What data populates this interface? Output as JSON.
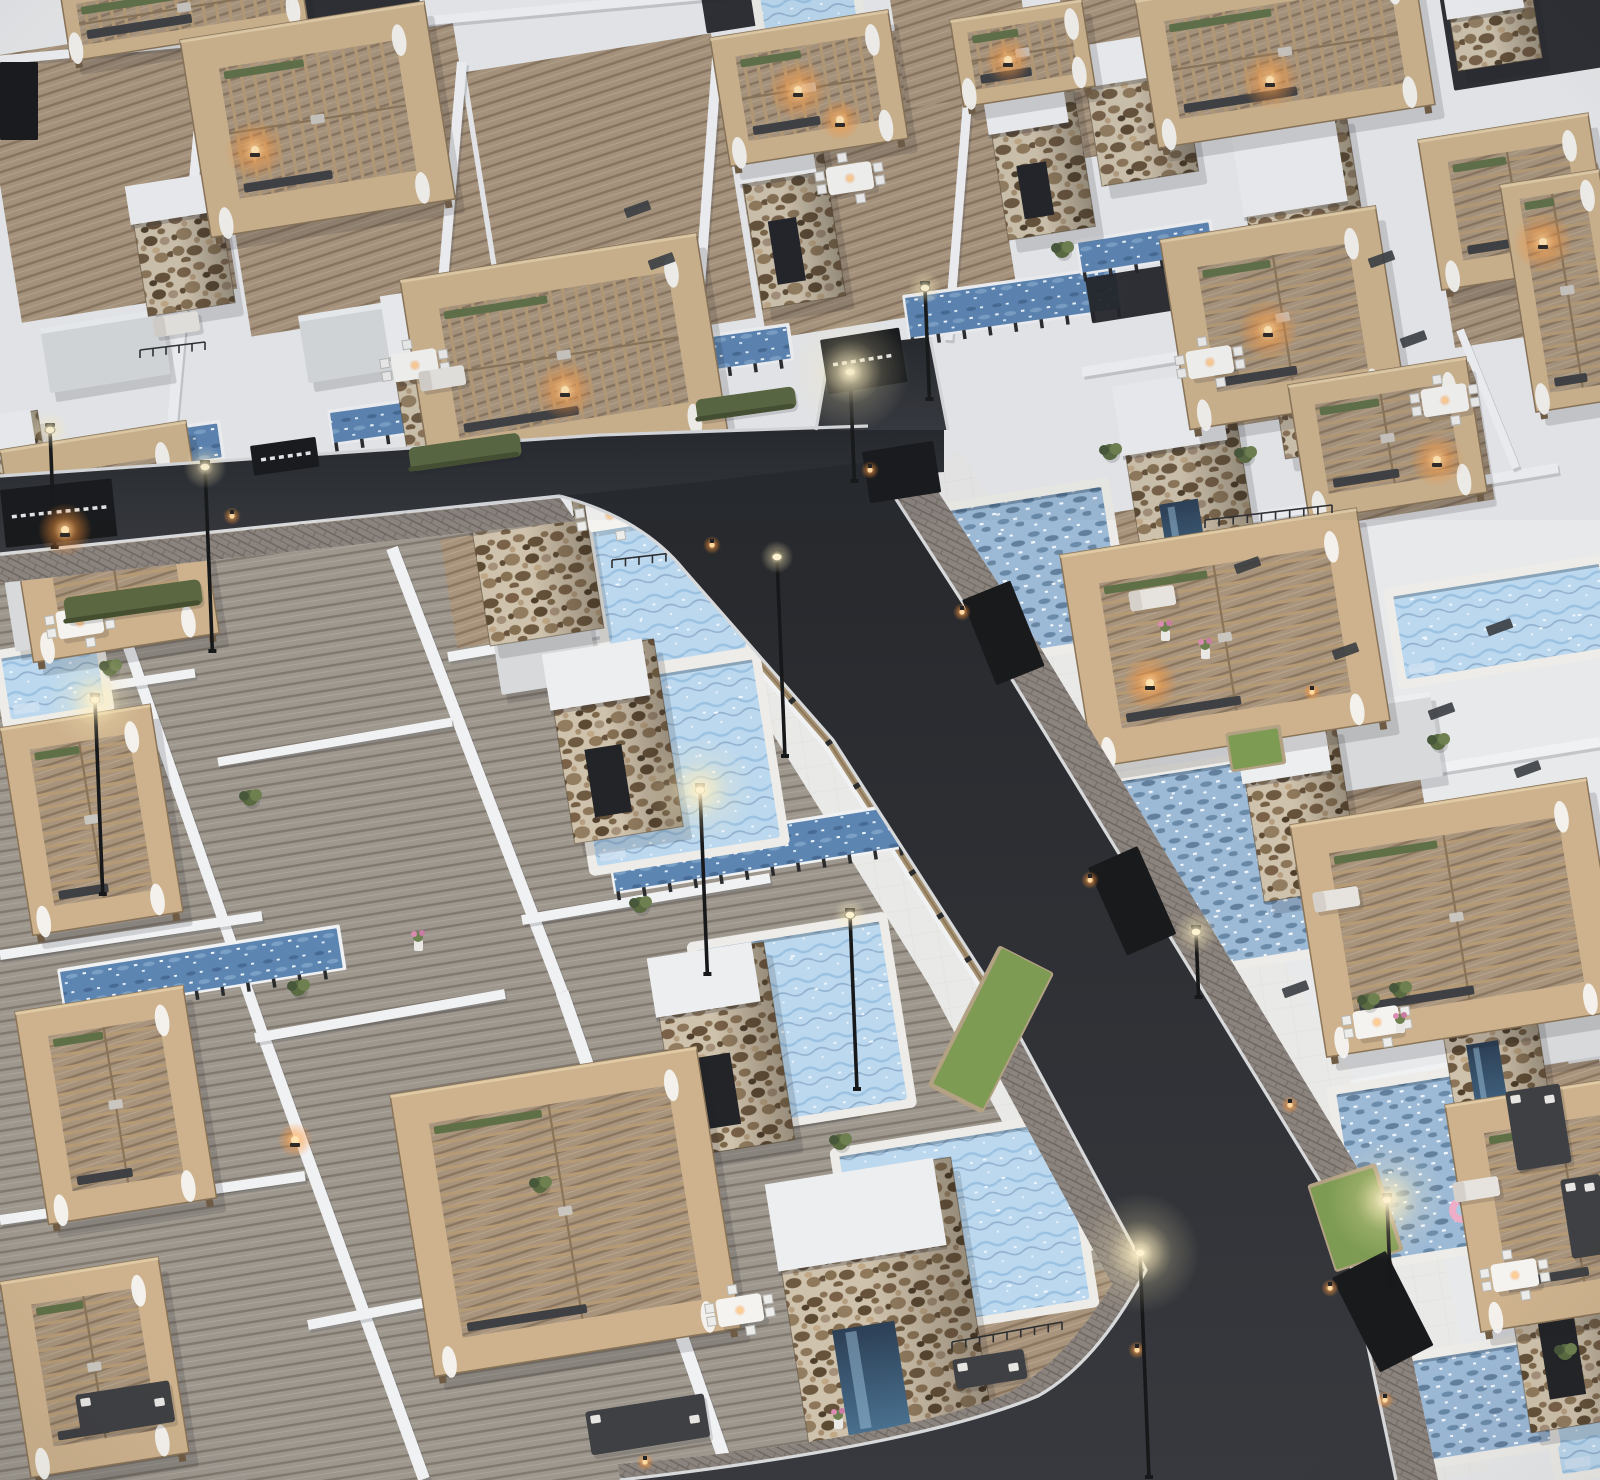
{
  "palette": {
    "bg": "#e8e9eb",
    "wall": "#f0f1f3",
    "wallShade": "#b9bdc2",
    "terrace": "#e9e9e7",
    "tile": "#dcdad5",
    "deckTan": "#a8947c",
    "deckTanLine": "#8b7660",
    "deckGray": "#9d978e",
    "deckGrayLine": "#81796f",
    "asphalt1": "#26282c",
    "asphalt2": "#37393e",
    "curb": "#d8d9db",
    "brick": "#8b837d",
    "brickLine": "#6f6862",
    "stoneBg": "#cfc2ac",
    "stone1": "#7a6148",
    "stone2": "#8d7659",
    "stone3": "#66523a",
    "stone4": "#937d60",
    "stone5": "#5c4a33",
    "stone6": "#a5907a",
    "stone7": "#4e3e2b",
    "stone8": "#b59d7f",
    "wood1": "#cdb28d",
    "wood2": "#b59a76",
    "woodDark": "#8a7458",
    "woodHi": "#e6d1ab",
    "poolLite1": "#bcd8ee",
    "poolLite2": "#9cc2e2",
    "poolDeep": "#6d92b6",
    "ripple": "#5e7f9f",
    "coping": "#edece8",
    "lapWater": "#5d85b2",
    "fenceWood": "#a5906f",
    "fenceLine": "#8a755a",
    "post": "#2a2b2d",
    "gate": "#191a1c",
    "gateDash": "#e8e9ea",
    "hedge": "#5a6741",
    "grass": "#7d9b52",
    "planterWood": "#b3a184",
    "green1": "#5a6b42",
    "green2": "#6f8050",
    "green3": "#47573a",
    "white": "#f4f3f0",
    "chair": "#ececea",
    "lampPole": "#17181a",
    "lampGlow": "#fff3cf",
    "fire": "#ffb45e",
    "fireCore": "#ffe3b0",
    "dark": "#3f4043",
    "darker": "#232428",
    "windowC": "#3a3d41",
    "curtain": "#f5f4f1",
    "shadow": "rgba(30,33,40,0.16)",
    "pink": "#eeaec7",
    "glass1": "#2c3f55",
    "glass2": "#49708f"
  },
  "canvas": {
    "w": 1600,
    "h": 1480,
    "tilt": -9
  },
  "roads": {
    "hPoly": "0,476 600,435 868,426 944,428 944,472 560,496 0,554",
    "apron": "816,430 830,348 930,337 948,430",
    "vPath": "M560,496 Q642,518 684,570 L833,740 L1000,1000 L1146,1270 Q1098,1362 1038,1396 Q918,1446 620,1480 L1396,1480 L1340,1214 L1150,904 L1000,660 L872,462 Q790,471 700,482 Z",
    "swR": "870,462 1000,660 1150,904 1340,1214 1396,1480 1438,1480 1380,1205 1190,893 1040,647 910,449",
    "swL": "M1146,1270 L1000,1000 L966,1016 L1112,1284 Q1066,1360 1010,1392 Q900,1440 618,1464 L620,1480 Q918,1446 1038,1396 Q1098,1362 1146,1270 Z",
    "swB": "0,556 560,498 576,521 0,583",
    "curbA": "M0,476 L600,435 L868,426",
    "curbB": "M0,554 L560,496",
    "curbC": "M560,496 Q642,518 684,570 L833,740 L1000,1000 L1146,1270 Q1098,1362 1038,1396 Q918,1446 620,1480",
    "curbD": "M872,462 L1000,660 L1150,904 L1340,1214 L1396,1480",
    "curbE": "M830,348 L816,430 M930,337 L948,430"
  },
  "regions": {
    "lowerLeftDeck": "0,560 530,495 700,560 860,760 1010,1010 1150,1262 1080,1390 950,1448 618,1480 0,1480",
    "terraceBandL": "M640,520 L800,700 L965,965 L1112,1240",
    "terraceBandR": "M918,478 L1046,672 L1196,915 L1386,1225 L1440,1480",
    "cornerTerrace": [
      545,
      478,
      205,
      215
    ]
  },
  "walls": [
    [
      205,
      58,
      172,
      425,
      10
    ],
    [
      462,
      62,
      430,
      432,
      10
    ],
    [
      718,
      45,
      690,
      420,
      10
    ],
    [
      973,
      35,
      948,
      340,
      9
    ],
    [
      0,
      60,
      980,
      -30,
      9
    ],
    [
      1082,
      372,
      1368,
      326,
      10
    ],
    [
      1212,
      524,
      1558,
      468,
      10
    ],
    [
      1242,
      800,
      1600,
      742,
      10
    ],
    [
      1352,
      1085,
      1600,
      1038,
      10
    ],
    [
      1448,
      1368,
      1600,
      1318,
      10
    ],
    [
      1460,
      330,
      1516,
      468,
      8
    ],
    [
      1320,
      600,
      1382,
      742,
      8
    ],
    [
      1560,
      840,
      1600,
      1035,
      8
    ],
    [
      392,
      548,
      562,
      992,
      12
    ],
    [
      562,
      992,
      724,
      1458,
      13
    ],
    [
      108,
      588,
      262,
      1032,
      11
    ],
    [
      262,
      1032,
      424,
      1479,
      12
    ],
    [
      448,
      657,
      700,
      614,
      10
    ],
    [
      522,
      920,
      770,
      878,
      10
    ],
    [
      598,
      1152,
      858,
      1110,
      11
    ],
    [
      0,
      702,
      195,
      673,
      9
    ],
    [
      0,
      955,
      262,
      916,
      10
    ],
    [
      0,
      1220,
      305,
      1176,
      10
    ],
    [
      218,
      762,
      452,
      722,
      9
    ],
    [
      255,
      1038,
      505,
      994,
      10
    ],
    [
      308,
      1325,
      565,
      1276,
      10
    ]
  ],
  "fences": [
    [
      684,
      570,
      833,
      740
    ],
    [
      833,
      740,
      1000,
      1000
    ],
    [
      1000,
      1000,
      1146,
      1270
    ],
    [
      880,
      462,
      1000,
      660
    ],
    [
      1000,
      660,
      1150,
      904
    ],
    [
      1150,
      904,
      1340,
      1214
    ],
    [
      1340,
      1214,
      1392,
      1470
    ],
    [
      0,
      560,
      250,
      532
    ],
    [
      250,
      532,
      560,
      499
    ],
    [
      560,
      498,
      742,
      474
    ]
  ],
  "strips": [
    [
      14,
      452,
      205,
      34,
      -8
    ],
    [
      330,
      413,
      115,
      30,
      -8
    ],
    [
      455,
      398,
      90,
      28,
      -8
    ],
    [
      620,
      350,
      168,
      32,
      -8
    ],
    [
      905,
      298,
      212,
      40,
      -8
    ],
    [
      610,
      852,
      292,
      40,
      -9
    ],
    [
      60,
      972,
      280,
      40,
      -9
    ],
    [
      1078,
      243,
      132,
      30,
      -9
    ]
  ],
  "poolsLight": [
    [
      588,
      514,
      134,
      158
    ],
    [
      568,
      690,
      185,
      180
    ],
    [
      695,
      952,
      185,
      180
    ],
    [
      838,
      1158,
      225,
      180
    ],
    [
      1532,
      1292,
      68,
      186
    ],
    [
      758,
      -6,
      92,
      64
    ],
    [
      1392,
      598,
      208,
      84
    ],
    [
      0,
      660,
      95,
      62
    ]
  ],
  "poolsRipple": [
    [
      932,
      515,
      170,
      150
    ],
    [
      1075,
      790,
      215,
      195
    ],
    [
      1335,
      1096,
      200,
      170
    ],
    [
      1302,
      1380,
      235,
      100
    ]
  ],
  "floaties": [
    [
      878,
      1215,
      12
    ],
    [
      1462,
      1210,
      13
    ]
  ],
  "towers": [
    [
      128,
      188,
      88,
      130,
      0
    ],
    [
      383,
      298,
      105,
      205,
      1
    ],
    [
      735,
      133,
      84,
      178,
      1
    ],
    [
      985,
      92,
      88,
      150,
      1
    ],
    [
      1080,
      48,
      98,
      140,
      0
    ],
    [
      1233,
      128,
      114,
      335,
      2
    ],
    [
      1115,
      388,
      115,
      235,
      2
    ],
    [
      465,
      486,
      115,
      162,
      0
    ],
    [
      545,
      656,
      110,
      190,
      1
    ],
    [
      650,
      960,
      115,
      200,
      1
    ],
    [
      768,
      1186,
      185,
      294,
      2
    ],
    [
      1238,
      736,
      98,
      168,
      0
    ],
    [
      1425,
      920,
      95,
      250,
      2
    ],
    [
      1492,
      1186,
      108,
      250,
      1
    ],
    [
      -12,
      418,
      50,
      150,
      0
    ],
    [
      1447,
      0,
      85,
      72,
      0
    ]
  ],
  "pergolas": [
    [
      60,
      -8,
      240,
      70,
      "v"
    ],
    [
      180,
      40,
      247,
      200,
      "v"
    ],
    [
      400,
      280,
      300,
      200,
      "v"
    ],
    [
      710,
      38,
      180,
      130,
      "v"
    ],
    [
      950,
      20,
      133,
      88,
      "v"
    ],
    [
      1135,
      0,
      280,
      150,
      "v"
    ],
    [
      1418,
      140,
      172,
      152,
      "h"
    ],
    [
      1160,
      240,
      218,
      192,
      "h"
    ],
    [
      1288,
      385,
      180,
      137,
      "h"
    ],
    [
      1500,
      185,
      100,
      230,
      "h"
    ],
    [
      1060,
      555,
      300,
      215,
      "h"
    ],
    [
      1290,
      825,
      300,
      235,
      "h"
    ],
    [
      1445,
      1105,
      220,
      230,
      "h"
    ],
    [
      0,
      450,
      188,
      215,
      "h"
    ],
    [
      0,
      728,
      152,
      210,
      "h"
    ],
    [
      15,
      1012,
      170,
      215,
      "h"
    ],
    [
      0,
      1282,
      160,
      198,
      "h"
    ],
    [
      390,
      1095,
      310,
      285,
      "h"
    ]
  ],
  "decksTan": [
    [
      -20,
      58,
      218,
      268
    ],
    [
      208,
      62,
      248,
      278
    ],
    [
      466,
      72,
      248,
      288
    ],
    [
      722,
      58,
      255,
      285
    ],
    [
      1098,
      515,
      135,
      140
    ],
    [
      1282,
      800,
      140,
      150
    ],
    [
      1420,
      1085,
      150,
      160
    ],
    [
      945,
      1295,
      215,
      185
    ],
    [
      1430,
      190,
      170,
      160
    ],
    [
      1165,
      250,
      215,
      185
    ],
    [
      1290,
      390,
      185,
      140
    ],
    [
      1060,
      0,
      290,
      160
    ],
    [
      890,
      0,
      130,
      110
    ],
    [
      440,
      540,
      150,
      110
    ],
    [
      1530,
      1070,
      70,
      210
    ]
  ],
  "canopies": [
    [
      0,
      553,
      188,
      100
    ],
    [
      488,
      608,
      98,
      88
    ],
    [
      40,
      328,
      122,
      66
    ],
    [
      298,
      316,
      100,
      68
    ],
    [
      1323,
      708,
      108,
      86
    ],
    [
      1498,
      993,
      105,
      78
    ]
  ],
  "gates": [
    [
      0,
      490,
      112,
      58,
      -6,
      1
    ],
    [
      250,
      446,
      66,
      30,
      -8,
      1
    ],
    [
      820,
      340,
      80,
      55,
      -9,
      1
    ],
    [
      862,
      452,
      72,
      52,
      -9,
      0
    ],
    [
      962,
      600,
      52,
      92,
      -22,
      0
    ],
    [
      1088,
      868,
      54,
      96,
      -24,
      0
    ],
    [
      1332,
      1278,
      60,
      106,
      -27,
      0
    ],
    [
      0,
      62,
      38,
      78,
      0,
      0
    ]
  ],
  "darkRects": [
    [
      1085,
      278,
      118,
      46,
      -9
    ],
    [
      288,
      -12,
      128,
      58,
      -9
    ],
    [
      700,
      -10,
      96,
      44,
      -9
    ],
    [
      1438,
      -12,
      168,
      104,
      -9
    ]
  ],
  "hedges": [
    [
      63,
      598,
      138,
      26
    ],
    [
      408,
      448,
      112,
      24
    ],
    [
      695,
      400,
      100,
      22
    ]
  ],
  "grassPlanters": [
    [
      1228,
      736,
      50,
      34,
      -9
    ],
    [
      1002,
      948,
      56,
      152,
      27
    ],
    [
      1310,
      1188,
      66,
      86,
      -18
    ]
  ],
  "lamps": [
    [
      50,
      430,
      118,
      0.5
    ],
    [
      205,
      467,
      185,
      0.6
    ],
    [
      95,
      700,
      195,
      0.8
    ],
    [
      700,
      790,
      185,
      0.9
    ],
    [
      777,
      557,
      200,
      0.4
    ],
    [
      925,
      288,
      112,
      0.4
    ],
    [
      850,
      372,
      110,
      1
    ],
    [
      1140,
      1253,
      225,
      1
    ],
    [
      1387,
      1200,
      88,
      1
    ],
    [
      1196,
      932,
      66,
      0.6
    ],
    [
      850,
      915,
      175,
      0.4
    ]
  ],
  "wallLights": [
    [
      870,
      470
    ],
    [
      962,
      612
    ],
    [
      1090,
      880
    ],
    [
      1330,
      1288
    ],
    [
      1385,
      1400
    ],
    [
      1137,
      1350
    ],
    [
      712,
      545
    ],
    [
      232,
      516
    ],
    [
      645,
      1462
    ],
    [
      1312,
      692
    ],
    [
      1290,
      1105
    ]
  ],
  "fires": [
    [
      255,
      150,
      1
    ],
    [
      565,
      390,
      1
    ],
    [
      798,
      90,
      1
    ],
    [
      840,
      120,
      0.7
    ],
    [
      1008,
      60,
      0.8
    ],
    [
      1270,
      80,
      1
    ],
    [
      1543,
      242,
      1
    ],
    [
      1268,
      330,
      1
    ],
    [
      1437,
      460,
      0.9
    ],
    [
      1150,
      683,
      0.9
    ],
    [
      65,
      530,
      0.9
    ],
    [
      295,
      1140,
      0.6
    ]
  ],
  "tables": [
    [
      585,
      505
    ],
    [
      55,
      612
    ],
    [
      390,
      355
    ],
    [
      825,
      168
    ],
    [
      1185,
      352
    ],
    [
      1420,
      390
    ],
    [
      1490,
      1265
    ],
    [
      1352,
      1012
    ],
    [
      715,
      1300
    ]
  ],
  "loungers": [
    [
      1128,
      592
    ],
    [
      1312,
      893
    ],
    [
      1452,
      1183
    ],
    [
      152,
      318
    ],
    [
      418,
      372
    ]
  ],
  "sofas": [
    [
      952,
      1360,
      72,
      30
    ],
    [
      75,
      1395,
      95,
      42
    ],
    [
      585,
      1412,
      120,
      44
    ],
    [
      1505,
      1092,
      55,
      80
    ],
    [
      1560,
      1180,
      40,
      80
    ]
  ],
  "plants": [
    [
      945,
      588
    ],
    [
      1205,
      1068
    ],
    [
      840,
      1142
    ],
    [
      1110,
      452
    ],
    [
      1340,
      1372
    ],
    [
      250,
      798
    ],
    [
      110,
      668
    ],
    [
      298,
      988
    ],
    [
      1245,
      455
    ],
    [
      1062,
      250
    ],
    [
      1438,
      742
    ],
    [
      1565,
      1352
    ],
    [
      640,
      905
    ],
    [
      540,
      1185
    ],
    [
      1400,
      990
    ],
    [
      1368,
      1002
    ]
  ],
  "flowers": [
    [
      1165,
      630
    ],
    [
      1205,
      648
    ],
    [
      838,
      1418
    ],
    [
      418,
      940
    ],
    [
      1400,
      1022
    ]
  ],
  "windows": [
    [
      1392,
      250
    ],
    [
      1424,
      330
    ],
    [
      1356,
      642
    ],
    [
      1452,
      702
    ],
    [
      1538,
      760
    ],
    [
      1306,
      980
    ],
    [
      1258,
      556
    ],
    [
      1510,
      618
    ],
    [
      648,
      200
    ],
    [
      672,
      252
    ]
  ],
  "railings": [
    [
      612,
      560,
      868,
      530
    ],
    [
      1205,
      520,
      1332,
      505
    ],
    [
      952,
      1342,
      1062,
      1322
    ],
    [
      140,
      350,
      205,
      342
    ]
  ]
}
